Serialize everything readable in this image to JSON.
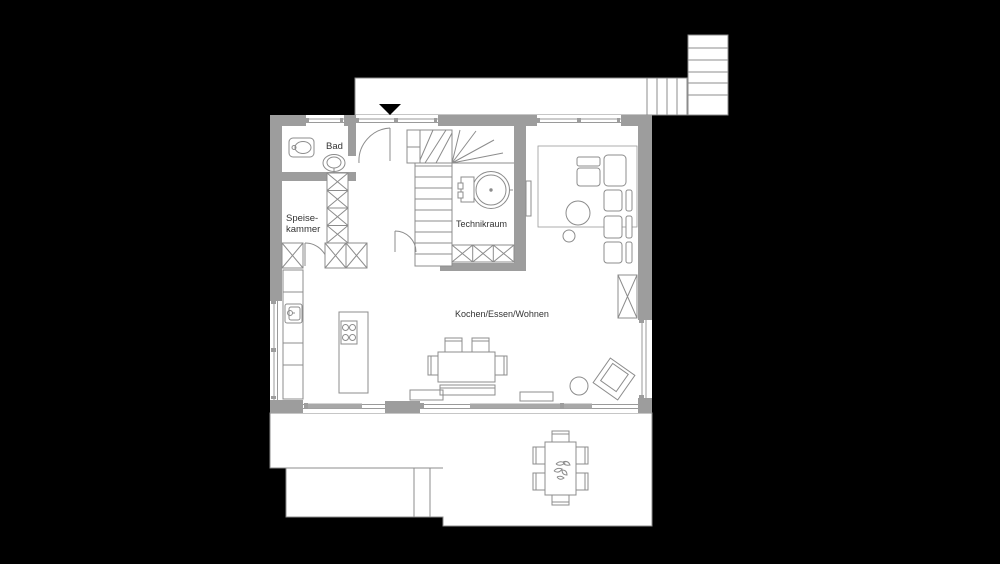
{
  "plan": {
    "type": "floor-plan",
    "labels": {
      "bad": "Bad",
      "speisekammer_line1": "Speise-",
      "speisekammer_line2": "kammer",
      "technikraum": "Technikraum",
      "wohnbereich": "Kochen/Essen/Wohnen"
    },
    "colors": {
      "background": "#000000",
      "floor": "#ffffff",
      "wall": "#9d9d9d",
      "outline": "#8c8c8c",
      "glass_panel": "#a8a8a8",
      "text": "#333333",
      "entrance_marker": "#000000"
    },
    "icons": {
      "entrance_arrow": "triangle-down-icon"
    }
  }
}
